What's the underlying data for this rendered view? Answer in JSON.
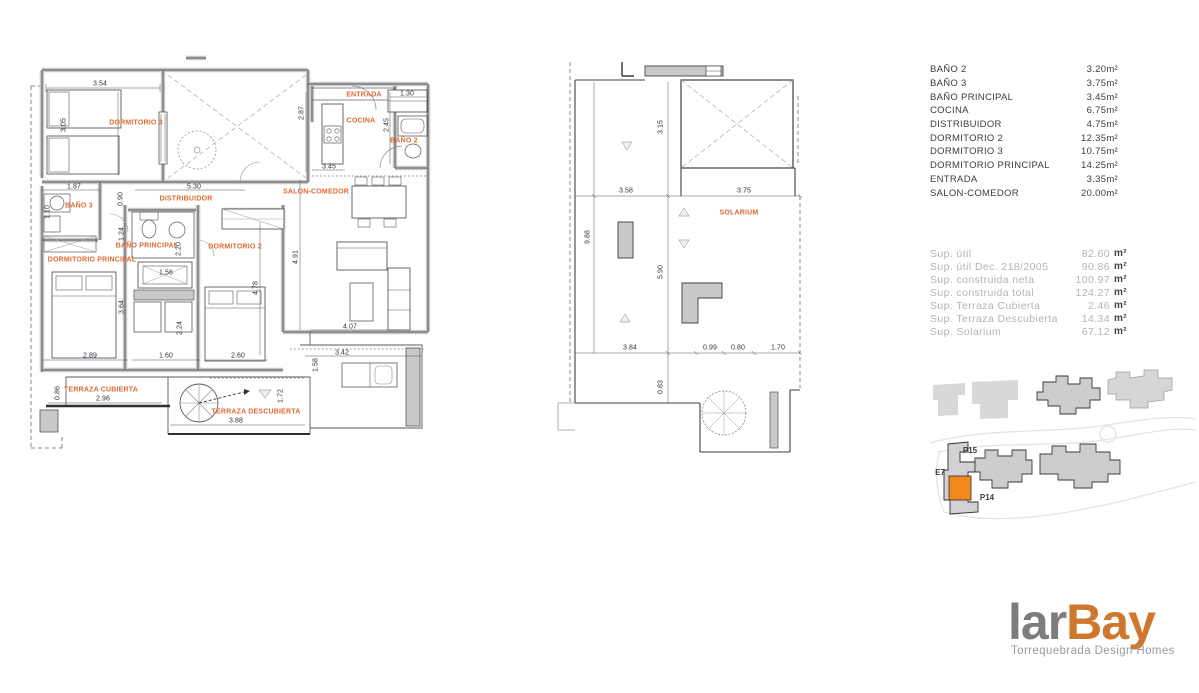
{
  "theme": {
    "accent_orange": "#DE6A31",
    "site_highlight": "#F08A1E",
    "logo_gray": "#7D7D7D",
    "logo_orange": "#D0772F",
    "wall_gray": "#C9C9C9",
    "line_dark": "#54545C"
  },
  "plan1": {
    "rooms": [
      "DORMITORIO 3",
      "BAÑO 3",
      "DISTRIBUIDOR",
      "BAÑO PRINCIPAL",
      "DORMITORIO PRINCIPAL",
      "DORMITORIO 2",
      "SALON-COMEDOR",
      "ENTRADA",
      "COCINA",
      "BAÑO 2",
      "TERRAZA CUBIERTA",
      "TERRAZA DESCUBIERTA"
    ],
    "dims": [
      "3.54",
      "3.05",
      "1.87",
      "0.90",
      "5.30",
      "2.87",
      "1.30",
      "2.45",
      "3.45",
      "1.10",
      "1.24",
      "2.20",
      "1.56",
      "3.64",
      "2.24",
      "2.89",
      "1.60",
      "2.60",
      "4.91",
      "4.78",
      "4.07",
      "3.42",
      "1.58",
      "1.72",
      "2.96",
      "0.86",
      "3.88"
    ]
  },
  "plan2": {
    "rooms": [
      "SOLARIUM"
    ],
    "dims": [
      "3.15",
      "3.58",
      "3.75",
      "9.88",
      "5.90",
      "3.84",
      "0.99",
      "0.80",
      "1.70",
      "0.83"
    ]
  },
  "area_table": {
    "rows": [
      {
        "name": "BAÑO 2",
        "value": "3.20m²"
      },
      {
        "name": "BAÑO 3",
        "value": "3.75m²"
      },
      {
        "name": "BAÑO PRINCIPAL",
        "value": "3.45m²"
      },
      {
        "name": "COCINA",
        "value": "6.75m²"
      },
      {
        "name": "DISTRIBUIDOR",
        "value": "4.75m²"
      },
      {
        "name": "DORMITORIO 2",
        "value": "12.35m²"
      },
      {
        "name": "DORMITORIO 3",
        "value": "10.75m²"
      },
      {
        "name": "DORMITORIO PRINCIPAL",
        "value": "14.25m²"
      },
      {
        "name": "ENTRADA",
        "value": "3.35m²"
      },
      {
        "name": "SALON-COMEDOR",
        "value": "20.00m²"
      }
    ]
  },
  "sup_table": {
    "rows": [
      {
        "label": "Sup. útil",
        "value": "82.60",
        "unit": "m²"
      },
      {
        "label": "Sup. útil  Dec. 218/2005",
        "value": "90.86",
        "unit": "m²"
      },
      {
        "label": "Sup. construida neta",
        "value": "100.97",
        "unit": "m²"
      },
      {
        "label": "Sup. construida total",
        "value": "124.27",
        "unit": "m²"
      },
      {
        "label": "Sup. Terraza Cubierta",
        "value": "2.46",
        "unit": "m²"
      },
      {
        "label": "Sup. Terraza Descubierta",
        "value": "14.34",
        "unit": "m²"
      },
      {
        "label": "Sup. Solarium",
        "value": "67.12",
        "unit": "m²"
      }
    ]
  },
  "site_plan": {
    "labels": [
      "P15",
      "E7",
      "P14"
    ]
  },
  "logo": {
    "part1": "lar",
    "part2": "Bay",
    "tagline": "Torrequebrada Design Homes"
  }
}
